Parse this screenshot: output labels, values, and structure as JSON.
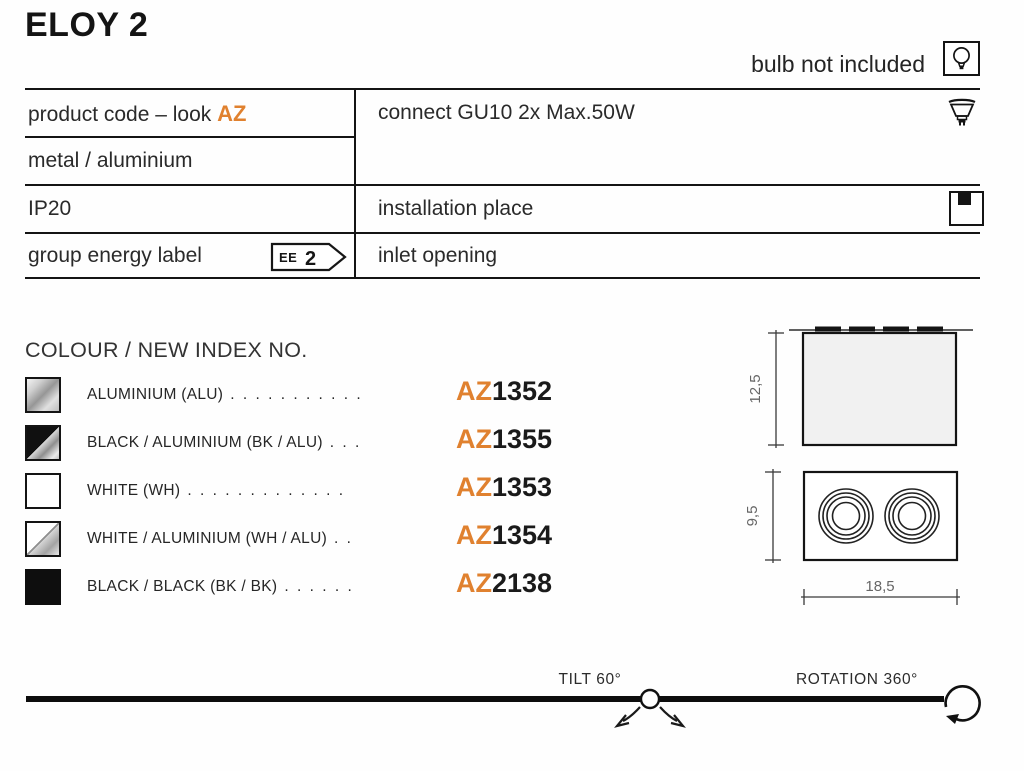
{
  "title": "ELOY 2",
  "bulb_note": "bulb not included",
  "spec_table": {
    "row1_left_label": "product code – look",
    "row1_left_code": "AZ",
    "row1_right": "connect GU10 2x Max.50W",
    "row2_left": "metal / aluminium",
    "row3_left": "IP20",
    "row3_right": "installation place",
    "row4_left": "group energy label",
    "row4_right": "inlet opening",
    "energy_badge": {
      "ee": "EE",
      "num": "2"
    }
  },
  "colour": {
    "heading": "COLOUR / NEW INDEX NO.",
    "items": [
      {
        "label": "ALUMINIUM (ALU)",
        "dots": ". . . . . . . . . . .",
        "prefix": "AZ",
        "number": "1352",
        "swatch": "aluminium"
      },
      {
        "label": "BLACK / ALUMINIUM (BK / ALU)",
        "dots": ". . .",
        "prefix": "AZ",
        "number": "1355",
        "swatch": "black-aluminium"
      },
      {
        "label": "WHITE (WH)",
        "dots": ". . . . . . . . . . . . .",
        "prefix": "AZ",
        "number": "1353",
        "swatch": "white"
      },
      {
        "label": "WHITE / ALUMINIUM (WH / ALU)",
        "dots": ". .",
        "prefix": "AZ",
        "number": "1354",
        "swatch": "white-aluminium"
      },
      {
        "label": "BLACK / BLACK (BK / BK)",
        "dots": ". . . . . .",
        "prefix": "AZ",
        "number": "2138",
        "swatch": "black-black"
      }
    ]
  },
  "dimensions": {
    "side_height": "12,5",
    "front_depth": "9,5",
    "front_width": "18,5"
  },
  "footer": {
    "tilt": "TILT 60°",
    "rotation": "ROTATION 360°"
  },
  "icons": {
    "top_right": "bulb-icon",
    "connect_row": "gu10-socket-icon",
    "installation_row": "ceiling-mount-icon",
    "energy": "energy-label-arrow-badge",
    "tilt": "tilt-arrows-icon",
    "rotation": "rotation-arrow-icon"
  },
  "colors": {
    "accent_orange": "#e0812f",
    "text_dark": "#1d1d1d",
    "dim_grey": "#666666",
    "line_black": "#141414"
  }
}
